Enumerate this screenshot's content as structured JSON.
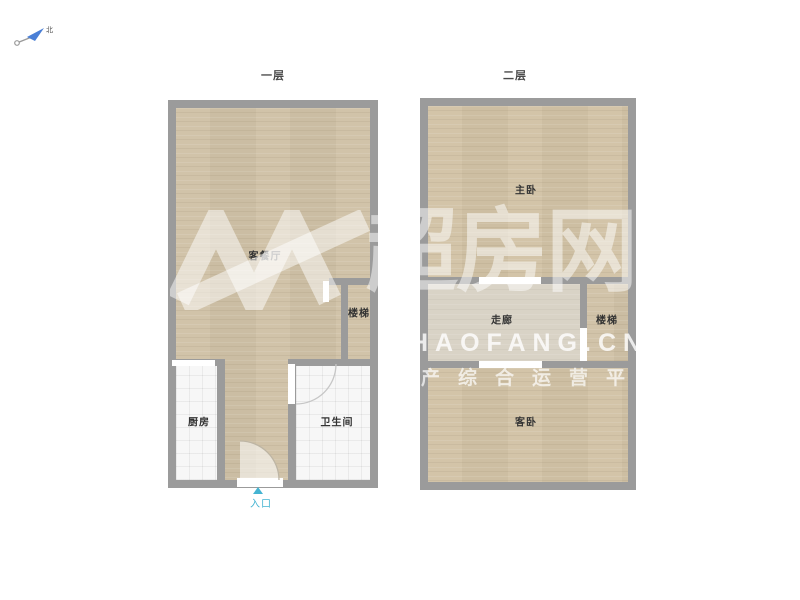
{
  "compass": {
    "north_label": "北"
  },
  "floor1": {
    "title": "一层",
    "rooms": {
      "living": "客餐厅",
      "stairs": "楼梯",
      "kitchen": "厨房",
      "bathroom": "卫生间"
    },
    "entrance_label": "入口"
  },
  "floor2": {
    "title": "二层",
    "rooms": {
      "master": "主卧",
      "corridor": "走廊",
      "stairs": "楼梯",
      "guest": "客卧"
    }
  },
  "watermark": {
    "logo_text": "超房网",
    "domain": "HAOFANG.CN",
    "slogan": "产综合运营平"
  },
  "colors": {
    "wall": "#9b9b9b",
    "wood_floor": "#cfc1a6",
    "corridor_floor": "#d9d3c6",
    "tile_floor": "#f7f7f7",
    "entrance_accent": "#45b4d2",
    "compass_blue": "#4a7fd6",
    "label_text": "#333333"
  }
}
